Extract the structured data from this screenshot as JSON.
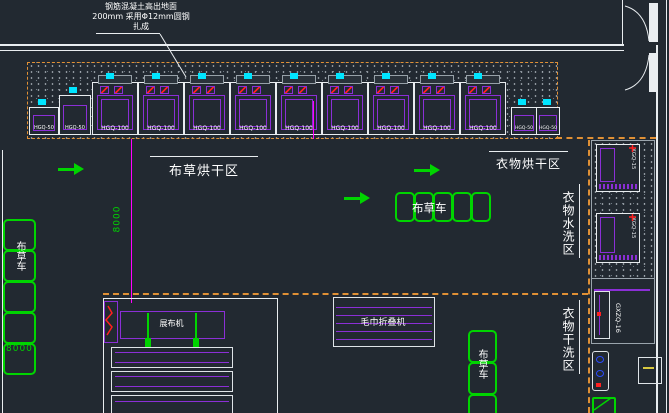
{
  "colors": {
    "background": "#222931",
    "line_white": "#e9edf0",
    "machine_purple": "#8b2fd6",
    "cart_green": "#00d400",
    "boundary_orange": "#e09035",
    "dimension_magenta": "#ff00ff",
    "detail_cyan": "#00e5ff",
    "mark_red": "#ff2020",
    "mark_blue": "#2a4bff"
  },
  "annotation": {
    "line1": "钢筋混凝土高出地面",
    "line2": "200mm 采用Φ12mm圆钢",
    "line3": "扎成"
  },
  "zones": {
    "linen_drying": "布草烘干区",
    "clothes_drying": "衣物烘干区",
    "clothes_washing": "衣物水洗区",
    "clothes_dry_cleaning": "衣物干洗区"
  },
  "carts": {
    "left": "布草车",
    "center": "布草车",
    "right": "布草车"
  },
  "dryers": [
    "HGQ-50",
    "HGQ-50",
    "HGQ-100",
    "HGQ-100",
    "HGQ-100",
    "HGQ-100",
    "HGQ-100",
    "HGQ-100",
    "HGQ-100",
    "HGQ-100",
    "HGQ-100",
    "HGQ-50",
    "HGQ-50"
  ],
  "machines": {
    "spreader": "展布机",
    "towel_folder": "毛巾折叠机",
    "washer_1": "XGQ-15",
    "washer_2": "XGQ-15",
    "dry_cleaner": "GXZQ-16"
  },
  "dimensions": {
    "vertical": "8000",
    "horizontal": "8000"
  }
}
